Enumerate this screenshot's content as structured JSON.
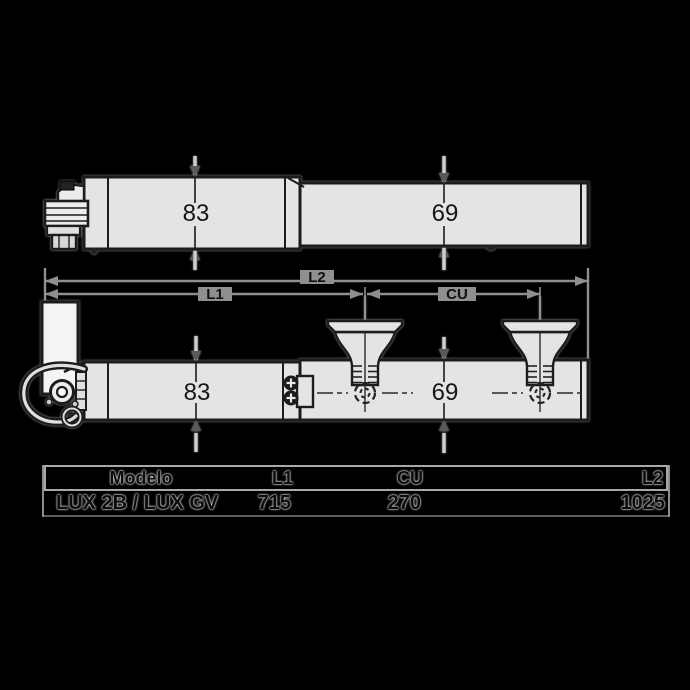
{
  "colors": {
    "background": "#000000",
    "part_fill": "#e4e4e4",
    "bracket_fill": "#f4f4f4",
    "outline": "#1c1c1c",
    "dimension_line": "#8f8f8f",
    "table_border": "#9a9a9a"
  },
  "top_view": {
    "body_width": "83",
    "rod_width": "69"
  },
  "side_view": {
    "body_width": "83",
    "rod_width": "69"
  },
  "dimension_labels": {
    "l1": "L1",
    "l2": "L2",
    "cu": "CU"
  },
  "table": {
    "headers": {
      "model": "Modelo",
      "l1": "L1",
      "cu": "CU",
      "l2": "L2"
    },
    "row": {
      "model": "LUX 2B / LUX GV",
      "l1": "715",
      "cu": "270",
      "l2": "1025"
    }
  }
}
